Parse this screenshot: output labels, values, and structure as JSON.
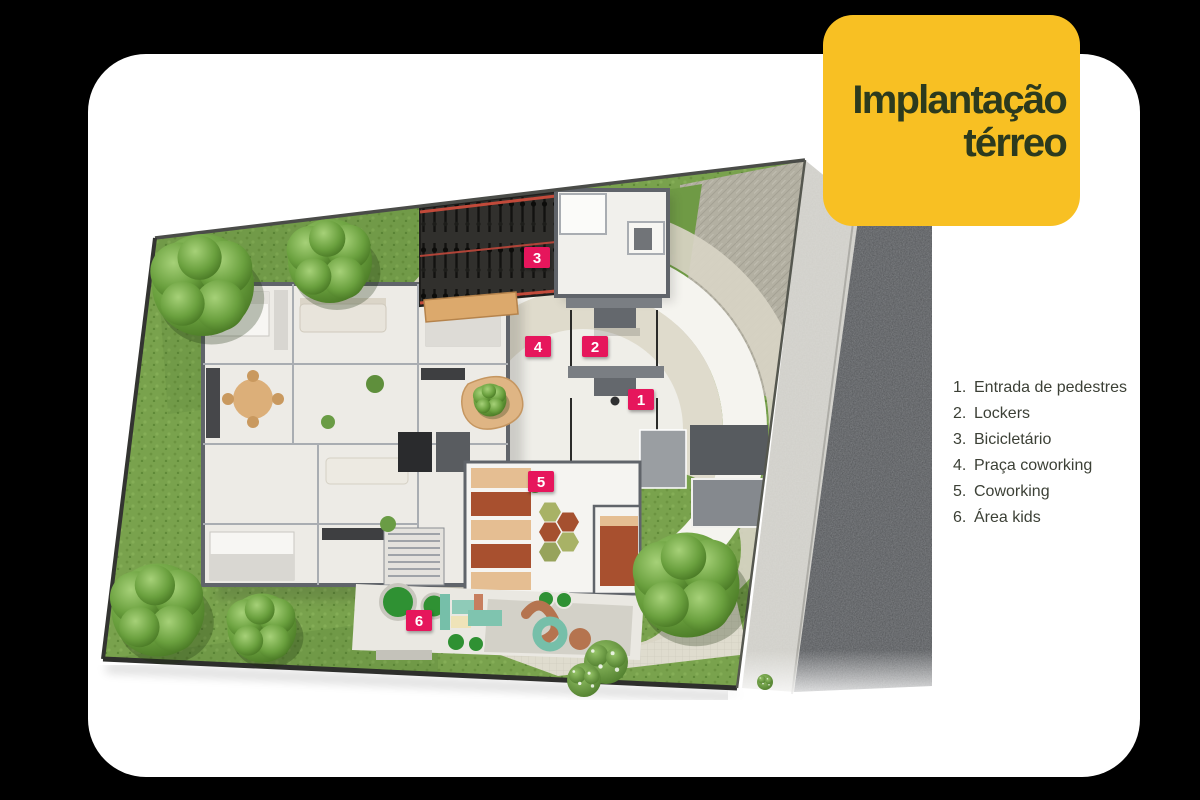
{
  "page": {
    "background_color": "#000000"
  },
  "card": {
    "background_color": "#FFFFFF"
  },
  "badge": {
    "line1": "Implantação",
    "line2": "térreo",
    "background_color": "#F8C023",
    "text_color": "#2C3A1E"
  },
  "legend": {
    "text_color": "#3C4036",
    "items": [
      {
        "number": "1.",
        "label": "Entrada de pedestres"
      },
      {
        "number": "2.",
        "label": "Lockers"
      },
      {
        "number": "3.",
        "label": "Bicicletário"
      },
      {
        "number": "4.",
        "label": "Praça coworking"
      },
      {
        "number": "5.",
        "label": "Coworking"
      },
      {
        "number": "6.",
        "label": "Área kids"
      }
    ]
  },
  "plan": {
    "marker_color": "#E6145C",
    "marker_text_color": "#FFFFFF",
    "markers": [
      {
        "number": "1"
      },
      {
        "number": "2"
      },
      {
        "number": "3"
      },
      {
        "number": "4"
      },
      {
        "number": "5"
      },
      {
        "number": "6"
      }
    ],
    "colors": {
      "grass": "#79A24D",
      "paving_light": "#DFDCCE",
      "paving_dark": "#B3B0A2",
      "road": "#6F7276",
      "sidewalk": "#CFCEC8",
      "building_floor": "#EDEBE6",
      "wall": "#60646A",
      "coworking_sofa": "#A8502F",
      "desk_wood": "#E5BE92",
      "kids_teal": "#7FC4AF",
      "bike_area": "#31302D",
      "bike_rail_red": "#C24A3A"
    }
  }
}
